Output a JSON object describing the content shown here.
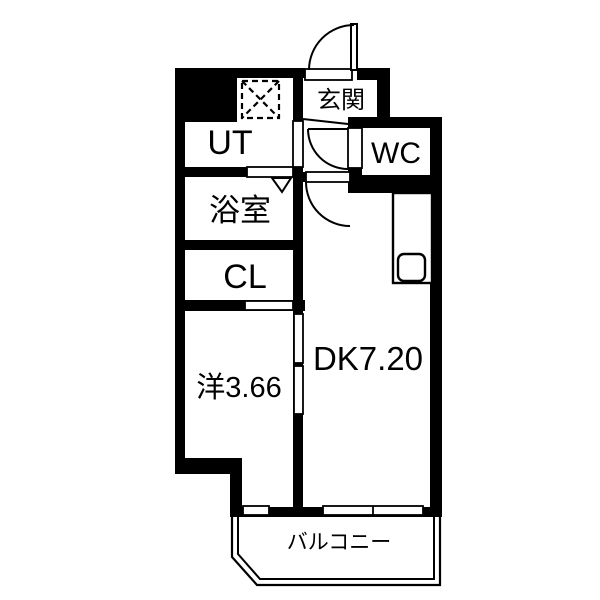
{
  "rooms": {
    "genkan": {
      "label": "玄関"
    },
    "ut": {
      "label": "UT"
    },
    "wc": {
      "label": "WC"
    },
    "bathroom": {
      "label": "浴室"
    },
    "closet": {
      "label": "CL"
    },
    "western_room": {
      "label": "洋3.66"
    },
    "dining_kitchen": {
      "label": "DK7.20"
    },
    "balcony": {
      "label": "バルコニー"
    }
  },
  "colors": {
    "wall": "#000000",
    "floor": "#ffffff",
    "line": "#000000"
  }
}
